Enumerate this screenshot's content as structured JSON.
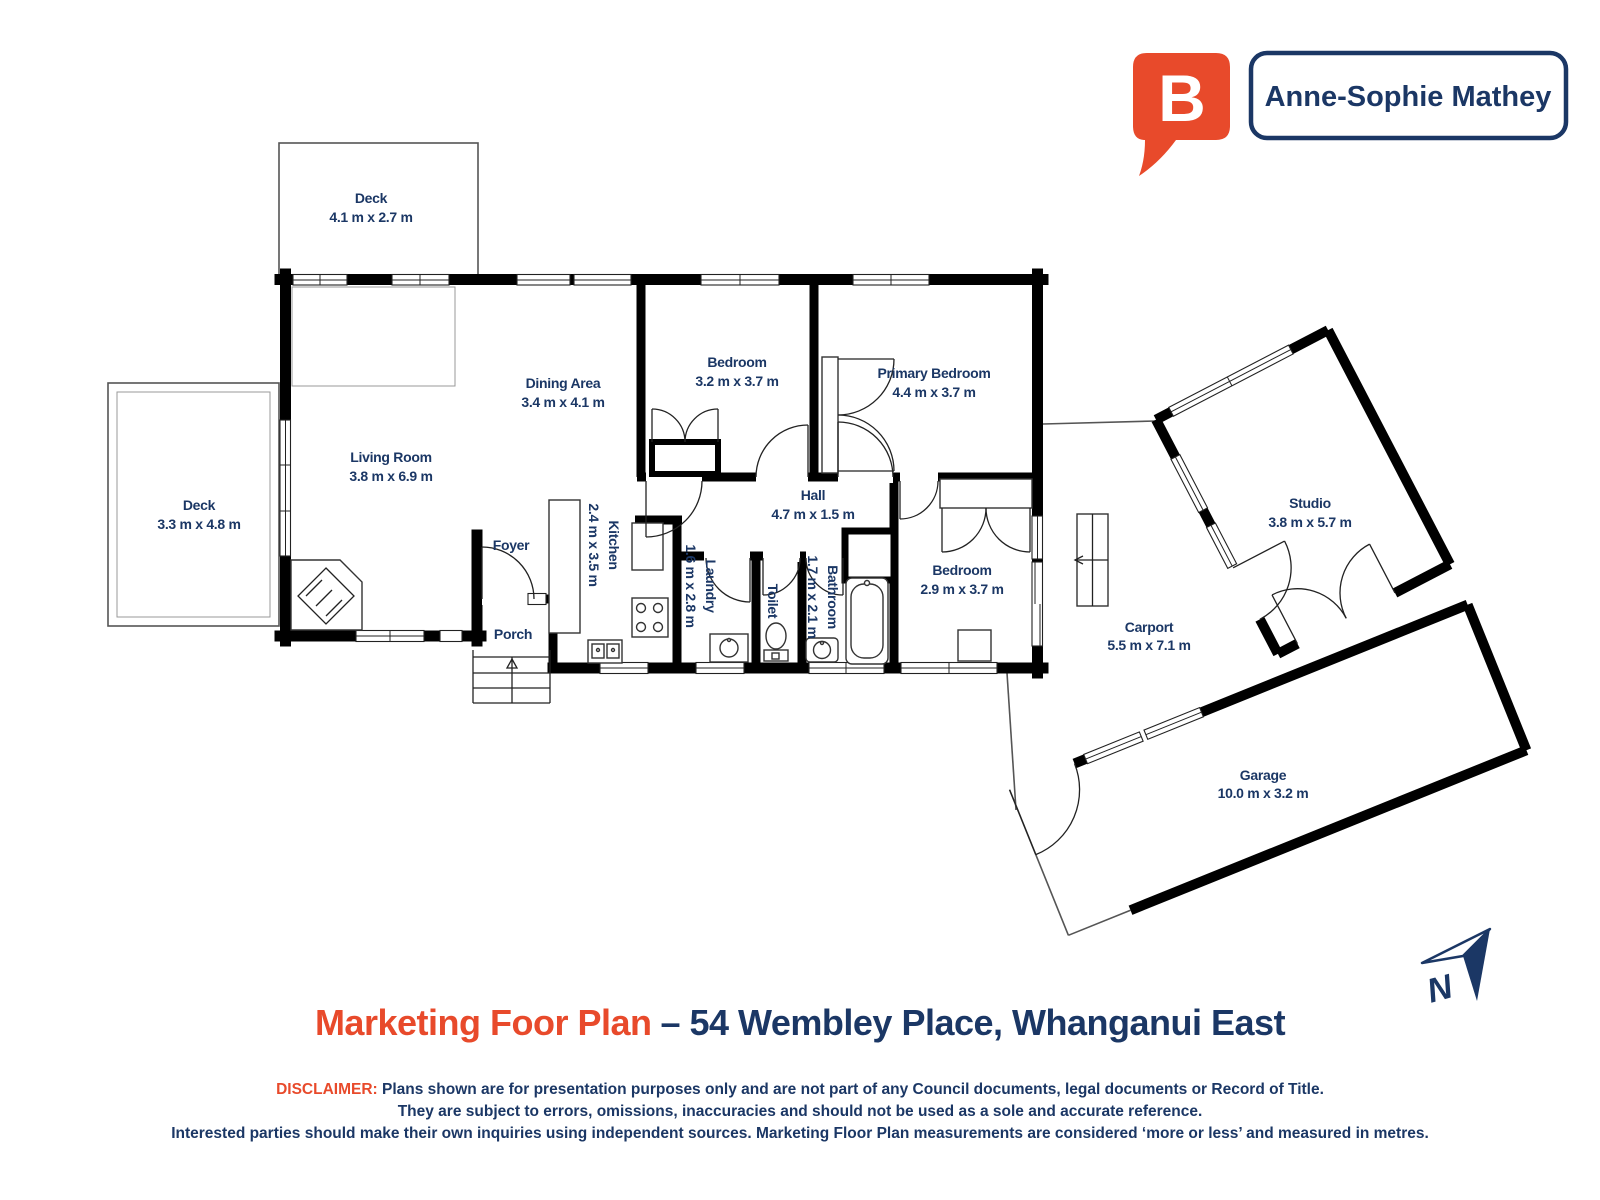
{
  "brand": {
    "logo_letter": "B",
    "agent_name": "Anne-Sophie Mathey",
    "logo_color": "#e84a2b",
    "navy_color": "#1b3765"
  },
  "title": {
    "highlight": "Marketing Foor Plan",
    "rest": "– 54 Wembley Place, Whanganui East"
  },
  "disclaimer": {
    "label": "DISCLAIMER:",
    "line1": "Plans shown are for presentation purposes only and are not part of any Council documents, legal documents or Record of Title.",
    "line2": "They are subject to errors, omissions, inaccuracies and should not be used as a sole and accurate reference.",
    "line3": "Interested parties should make their own inquiries using independent sources. Marketing Floor Plan measurements are considered ‘more or less’ and measured in metres."
  },
  "compass": {
    "label": "N"
  },
  "rooms": [
    {
      "name": "Deck",
      "dims": "4.1 m x 2.7 m"
    },
    {
      "name": "Deck",
      "dims": "3.3 m x 4.8 m"
    },
    {
      "name": "Living Room",
      "dims": "3.8 m x 6.9 m"
    },
    {
      "name": "Dining Area",
      "dims": "3.4 m x 4.1 m"
    },
    {
      "name": "Bedroom",
      "dims": "3.2 m x 3.7 m"
    },
    {
      "name": "Primary Bedroom",
      "dims": "4.4 m x 3.7 m"
    },
    {
      "name": "Hall",
      "dims": "4.7 m x 1.5 m"
    },
    {
      "name": "Foyer",
      "dims": ""
    },
    {
      "name": "Kitchen",
      "dims": "2.4 m x 3.5 m"
    },
    {
      "name": "Laundry",
      "dims": "1.6 m x 2.8 m"
    },
    {
      "name": "Toilet",
      "dims": ""
    },
    {
      "name": "Bathroom",
      "dims": "1.7 m x 2.1 m"
    },
    {
      "name": "Bedroom",
      "dims": "2.9 m x 3.7 m"
    },
    {
      "name": "Porch",
      "dims": ""
    },
    {
      "name": "Studio",
      "dims": "3.8 m x 5.7 m"
    },
    {
      "name": "Carport",
      "dims": "5.5 m x 7.1 m"
    },
    {
      "name": "Garage",
      "dims": "10.0 m x 3.2 m"
    }
  ]
}
